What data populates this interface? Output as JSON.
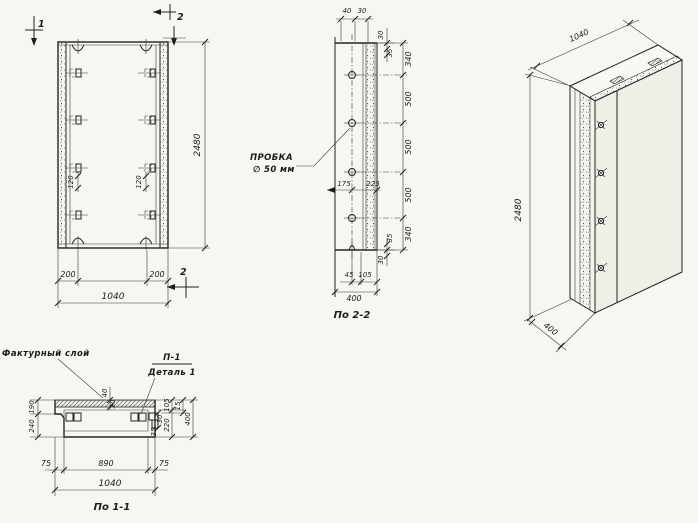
{
  "front_view": {
    "section_mark_1": "1",
    "section_mark_2_top": "2",
    "section_mark_2_bottom": "2",
    "dim_height": "2480",
    "dim_width": "1040",
    "dim_left_200": "200",
    "dim_right_200": "200",
    "dim_loop_left_120": "120",
    "dim_loop_right_120": "120"
  },
  "section_2_2": {
    "caption": "По 2-2",
    "plug_label_line1": "ПРОБКА",
    "plug_label_line2": "∅ 50 мм",
    "dim_top_40": "40",
    "dim_top_30": "30",
    "dim_edge_top_30": "30",
    "dim_edge_top_35": "35",
    "dim_chain": [
      "340",
      "500",
      "500",
      "500",
      "340"
    ],
    "dim_edge_bottom_35": "35",
    "dim_edge_bottom_30": "30",
    "dim_hole_175": "175",
    "dim_hole_225": "225",
    "dim_bottom_45": "45",
    "dim_bottom_105": "105",
    "dim_width_400": "400"
  },
  "iso_view": {
    "dim_width": "1040",
    "dim_height": "2480",
    "dim_depth": "400"
  },
  "section_1_1": {
    "caption": "По 1-1",
    "label_facing_layer": "Фактурный слой",
    "label_detail_ref": "П-1",
    "label_detail_name": "Деталь 1",
    "dim_top_40": "40",
    "dim_top_30": "30",
    "dim_left_190": "190",
    "dim_left_240": "240",
    "dim_right_105": "105",
    "dim_right_15": "15",
    "dim_right_220": "220",
    "dim_right_400": "400",
    "dim_det_30": "30",
    "dim_det_35": "35",
    "dim_bottom_75_left": "75",
    "dim_bottom_890": "890",
    "dim_bottom_75_right": "75",
    "dim_bottom_1040": "1040"
  }
}
